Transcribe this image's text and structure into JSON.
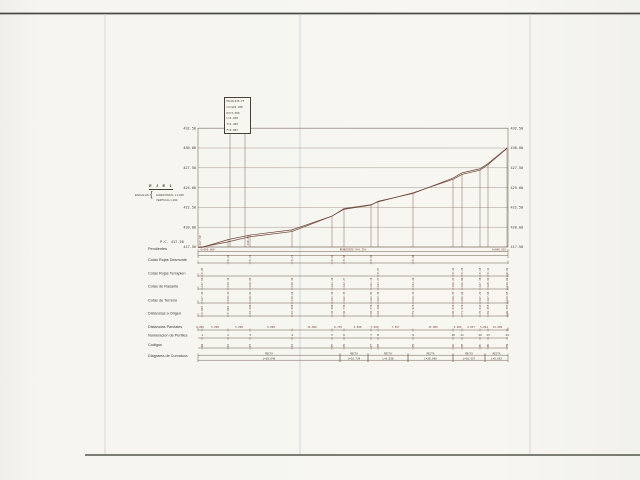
{
  "drawing": {
    "axis_title": "E J E   1",
    "scales_label": "ESCALAS",
    "scale_h": "HORIZONTAL 1:1.000",
    "scale_v": "VERTICAL 1:100",
    "datum_label": "P.C. 417.50",
    "curve_box_lines": [
      "PK=0+036.73",
      "CV=422.268",
      "KV=3.000",
      "L=4.938",
      "T=2.469",
      "F=0.003"
    ],
    "pendientes": {
      "left": "0+000.000",
      "center": "PENDIENTE P=5.25%",
      "right": "0+096.055"
    },
    "row_labels": [
      "Pendientes",
      "Cotas Rojas Desmonte",
      "Cotas Rojas Terraplen",
      "Cotas de Rasante",
      "Cotas de Terreno",
      "Distancias a Origen",
      "Distancias Parciales",
      "Numeracion de Perfiles",
      "Codigos",
      "Diagrama de Curvatura"
    ]
  },
  "chart_data": {
    "type": "line",
    "title": "EJE 1 - Perfil Longitudinal",
    "ylabel": "Cota (m)",
    "ylim": [
      417.5,
      432.5
    ],
    "grid": true,
    "elevation_ticks": [
      "432.50",
      "430.00",
      "427.50",
      "425.00",
      "422.50",
      "420.00",
      "417.50"
    ],
    "datum": 417.5,
    "legend_position": "none",
    "series": [
      {
        "name": "Terreno",
        "values": [
          417.45,
          418.43,
          419.01,
          419.66,
          421.4,
          422.35,
          422.84,
          423.2,
          424.34,
          426.05,
          426.66,
          427.2,
          427.9,
          429.95
        ]
      },
      {
        "name": "Rasante",
        "values": [
          417.5,
          418.15,
          418.8,
          419.45,
          421.4,
          422.27,
          422.78,
          423.27,
          424.26,
          426.21,
          426.86,
          427.38,
          428.04,
          429.99
        ]
      }
    ],
    "stations": [
      {
        "num": "1",
        "x": 202,
        "parcial": "0.000",
        "origen": "0.000",
        "terreno": 417.45,
        "rasante": 417.5,
        "roja": "0.05",
        "tipo": "T",
        "codigo": "IN"
      },
      {
        "num": "2",
        "x": 228,
        "parcial": "5.000",
        "origen": "5.000",
        "terreno": 418.43,
        "rasante": 418.15,
        "roja": "0.28",
        "tipo": "D",
        "codigo": "P2"
      },
      {
        "num": "3",
        "x": 250,
        "parcial": "5.000",
        "origen": "10.000",
        "terreno": 419.01,
        "rasante": 418.8,
        "roja": "0.21",
        "tipo": "D",
        "codigo": "P3"
      },
      {
        "num": "4",
        "x": 292,
        "parcial": "5.000",
        "origen": "15.000",
        "terreno": 419.66,
        "rasante": 419.45,
        "roja": "0.21",
        "tipo": "D",
        "codigo": "P4"
      },
      {
        "num": "5",
        "x": 332,
        "parcial": "15.000",
        "origen": "30.000",
        "terreno": 421.4,
        "rasante": 421.4,
        "roja": "0.02",
        "tipo": "D",
        "codigo": "P5"
      },
      {
        "num": "6",
        "x": 344,
        "parcial": "6.730",
        "origen": "36.730",
        "terreno": 422.35,
        "rasante": 422.27,
        "roja": "0.08",
        "tipo": "D",
        "codigo": "P6"
      },
      {
        "num": "7",
        "x": 371,
        "parcial": "3.846",
        "origen": "40.576",
        "terreno": 422.84,
        "rasante": 422.78,
        "roja": "0.06",
        "tipo": "D",
        "codigo": "P7"
      },
      {
        "num": "8",
        "x": 378,
        "parcial": "3.830",
        "origen": "44.406",
        "terreno": 423.2,
        "rasante": 423.27,
        "roja": "0.07",
        "tipo": "T",
        "codigo": "P8"
      },
      {
        "num": "9",
        "x": 413,
        "parcial": "7.567",
        "origen": "51.976",
        "terreno": 424.34,
        "rasante": 424.26,
        "roja": "0.08",
        "tipo": "D",
        "codigo": "P9"
      },
      {
        "num": "10",
        "x": 453,
        "parcial": "15.000",
        "origen": "66.976",
        "terreno": 426.05,
        "rasante": 426.21,
        "roja": "0.16",
        "tipo": "T",
        "codigo": "PA"
      },
      {
        "num": "11",
        "x": 462,
        "parcial": "5.000",
        "origen": "71.976",
        "terreno": 426.66,
        "rasante": 426.86,
        "roja": "0.20",
        "tipo": "T",
        "codigo": "PB"
      },
      {
        "num": "12",
        "x": 480,
        "parcial": "4.037",
        "origen": "76.013",
        "terreno": 427.2,
        "rasante": 427.38,
        "roja": "0.18",
        "tipo": "T",
        "codigo": "PC"
      },
      {
        "num": "13",
        "x": 488,
        "parcial": "5.042",
        "origen": "81.055",
        "terreno": 427.9,
        "rasante": 428.04,
        "roja": "0.14",
        "tipo": "T",
        "codigo": "PD"
      },
      {
        "num": "14",
        "x": 507,
        "parcial": "15.000",
        "origen": "96.055",
        "terreno": 429.95,
        "rasante": 429.99,
        "roja": "0.04",
        "tipo": "T",
        "codigo": "FN"
      }
    ],
    "curvatura_segments": [
      {
        "from": 198,
        "to": 340,
        "label1": "RECTA",
        "label2": "L=83.046"
      },
      {
        "from": 340,
        "to": 368,
        "label1": "RECTA",
        "label2": "L=16.739"
      },
      {
        "from": 368,
        "to": 408,
        "label1": "RECTA",
        "label2": "L=5.038"
      },
      {
        "from": 408,
        "to": 453,
        "label1": "RECTA",
        "label2": "L=28.098"
      },
      {
        "from": 453,
        "to": 485,
        "label1": "RECTA",
        "label2": "L=18.557"
      },
      {
        "from": 485,
        "to": 508,
        "label1": "RECTA",
        "label2": "L=8.062"
      }
    ]
  }
}
